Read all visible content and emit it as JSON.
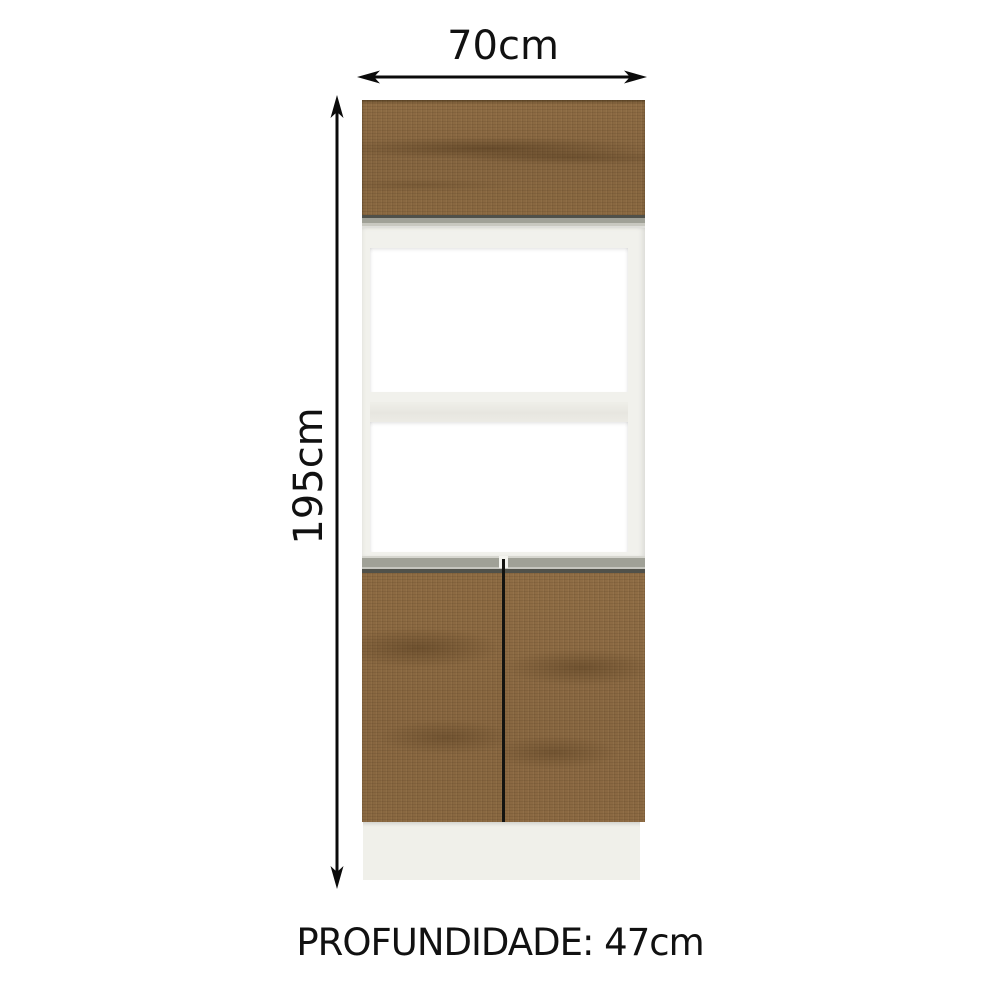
{
  "diagram": {
    "kind": "furniture-dimension-diagram",
    "subject": "kitchen tall oven cabinet with wood doors, two open niches and base plinth",
    "labels": {
      "width": "70cm",
      "height": "195cm",
      "upper_niche": "40cm",
      "lower_niche": "33cm",
      "depth": "PROFUNDIDADE: 47cm"
    },
    "colors": {
      "page_bg": "#ffffff",
      "text": "#111111",
      "arrow": "#0b0b0b",
      "wood_base": "#8a6940",
      "frame": "#f1f1ec",
      "handle_silver": "#a0a197",
      "handle_dark": "#50514a",
      "plinth": "#f0f0ea",
      "divider": "#131310"
    }
  }
}
